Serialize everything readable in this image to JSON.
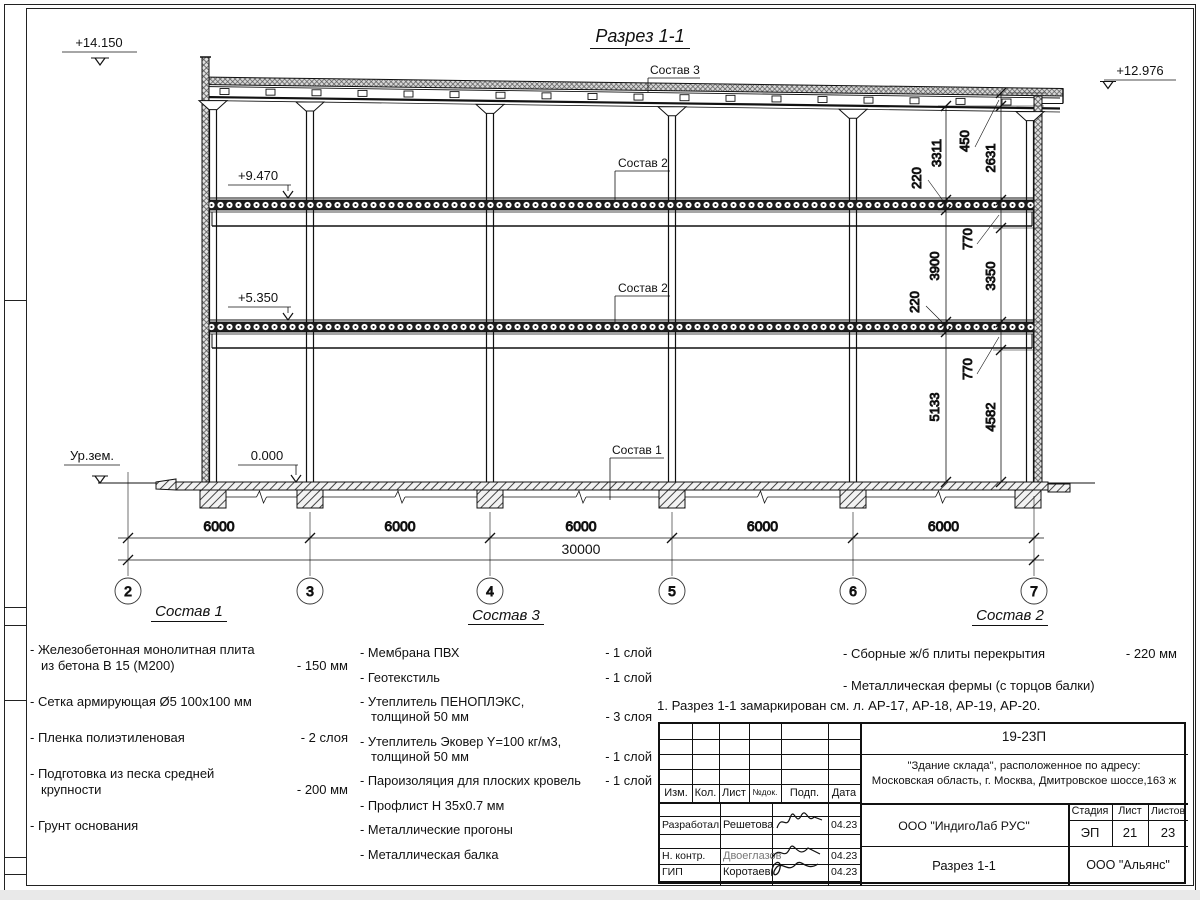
{
  "drawing": {
    "title": "Разрез 1-1",
    "elevation_marks": {
      "top_left": "+14.150",
      "top_right": "+12.976",
      "floor2": "+9.470",
      "floor1": "+5.350",
      "zero": "0.000",
      "ground": "Ур.зем."
    },
    "callouts": {
      "roof": "Состав 3",
      "slab_upper": "Состав 2",
      "slab_lower": "Состав 2",
      "floor_slab": "Состав 1"
    },
    "dims_inner": [
      "3311",
      "220",
      "3900",
      "220",
      "5133"
    ],
    "dims_outer": [
      "450",
      "2631",
      "770",
      "3350",
      "770",
      "4582"
    ],
    "bottom_dims": {
      "spans": [
        "6000",
        "6000",
        "6000",
        "6000",
        "6000"
      ],
      "total": "30000"
    },
    "axes": [
      "2",
      "3",
      "4",
      "5",
      "6",
      "7"
    ]
  },
  "specs": {
    "sostav1": {
      "title": "Состав 1",
      "items": [
        {
          "lines": [
            "- Железобетонная  монолитная плита",
            "из бетона В 15 (М200)"
          ],
          "value": "- 150 мм"
        },
        {
          "lines": [
            "- Сетка армирующая Ø5 100х100 мм"
          ],
          "value": ""
        },
        {
          "lines": [
            "- Пленка полиэтиленовая"
          ],
          "value": "-  2 слоя"
        },
        {
          "lines": [
            "- Подготовка из песка средней",
            "крупности"
          ],
          "value": "- 200 мм"
        },
        {
          "lines": [
            "- Грунт основания"
          ],
          "value": ""
        }
      ]
    },
    "sostav3": {
      "title": "Состав 3",
      "items": [
        {
          "lines": [
            "- Мембрана ПВХ"
          ],
          "value": "- 1 слой"
        },
        {
          "lines": [
            "- Геотекстиль"
          ],
          "value": "- 1 слой"
        },
        {
          "lines": [
            "- Утеплитель ПЕНОПЛЭКС,",
            "толщиной 50 мм"
          ],
          "value": "- 3 слоя"
        },
        {
          "lines": [
            "- Утеплитель Эковер Y=100 кг/м3,",
            "толщиной 50 мм"
          ],
          "value": "- 1 слой"
        },
        {
          "lines": [
            "- Пароизоляция для плоских кровель"
          ],
          "value": "- 1 слой"
        },
        {
          "lines": [
            "- Профлист Н 35х0.7 мм"
          ],
          "value": ""
        },
        {
          "lines": [
            "- Металлические прогоны"
          ],
          "value": ""
        },
        {
          "lines": [
            "- Металлическая балка"
          ],
          "value": ""
        }
      ]
    },
    "sostav2": {
      "title": "Состав 2",
      "items": [
        {
          "lines": [
            "- Сборные ж/б плиты перекрытия"
          ],
          "value": "- 220 мм"
        },
        {
          "lines": [
            "- Металлическая фермы (с торцов балки)"
          ],
          "value": ""
        }
      ]
    }
  },
  "note": "1. Разрез 1-1 замаркирован см. л. АР-17, АР-18, АР-19, АР-20.",
  "stamp": {
    "doc_number": "19-23П",
    "project_line1": "\"Здание склада\", расположенное по адресу:",
    "project_line2": "Московская область, г. Москва, Дмитровское шоссе,163 ж",
    "header_cols": [
      "Изм.",
      "Кол.",
      "Лист",
      "№док.",
      "Подп.",
      "Дата"
    ],
    "rows": [
      {
        "role": "Разработал",
        "name": "Решетова",
        "date": "04.23"
      },
      {
        "role": "Н. контр.",
        "name": "Двоеглазов",
        "date": "04.23"
      },
      {
        "role": "ГИП",
        "name": "Коротаев",
        "date": "04.23"
      }
    ],
    "company": "ООО \"ИндигоЛаб РУС\"",
    "stage_label": "Стадия",
    "sheet_label": "Лист",
    "sheets_label": "Листов",
    "stage": "ЭП",
    "sheet": "21",
    "sheets": "23",
    "drawing_name": "Разрез 1-1",
    "customer": "ООО \"Альянс\""
  }
}
